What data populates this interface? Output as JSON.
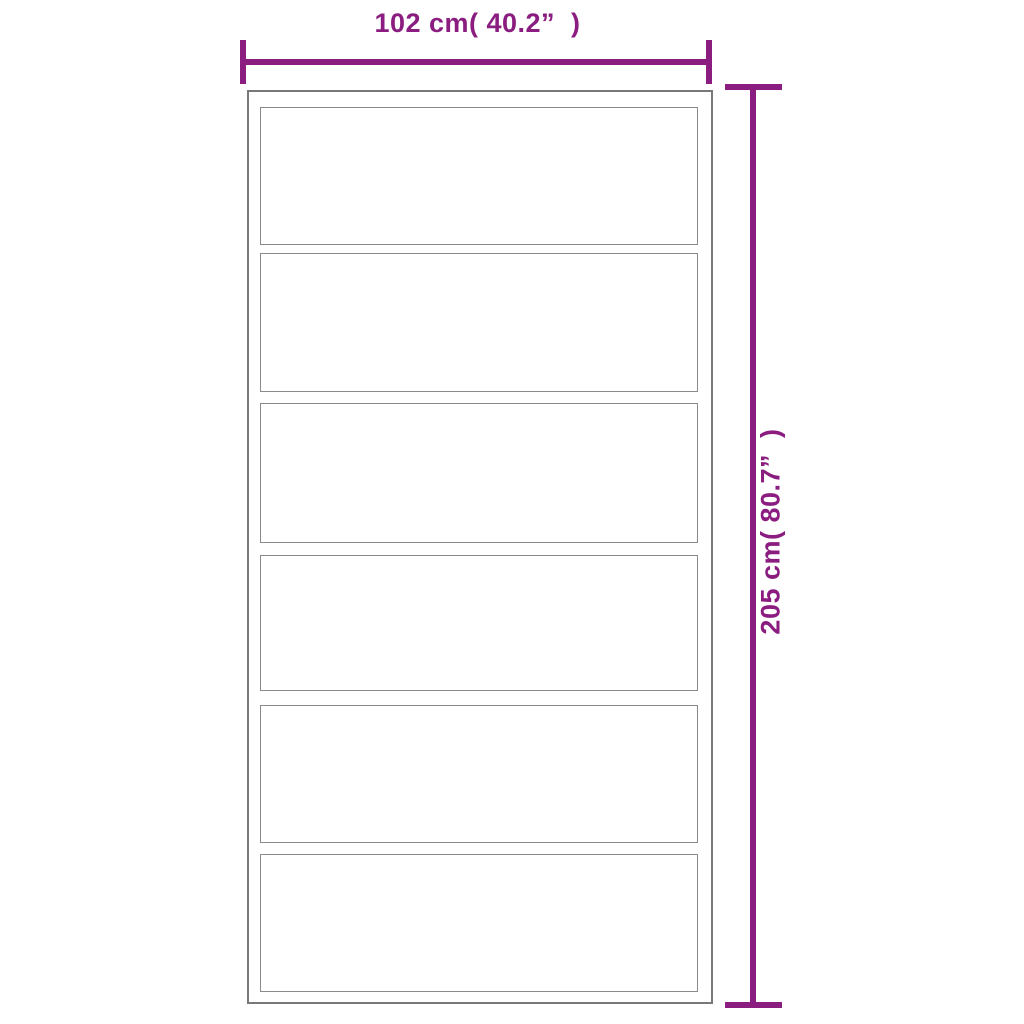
{
  "diagram": {
    "type": "product-dimension-diagram",
    "subject": "six-panel sliding door, front elevation",
    "accent_color": "#8B1D80",
    "outline_color": "#8A8A8A",
    "panel_count": 6,
    "dimensions": {
      "width_label": "102 cm( 40.2”  )",
      "height_label": "205 cm( 80.7”  )"
    }
  }
}
